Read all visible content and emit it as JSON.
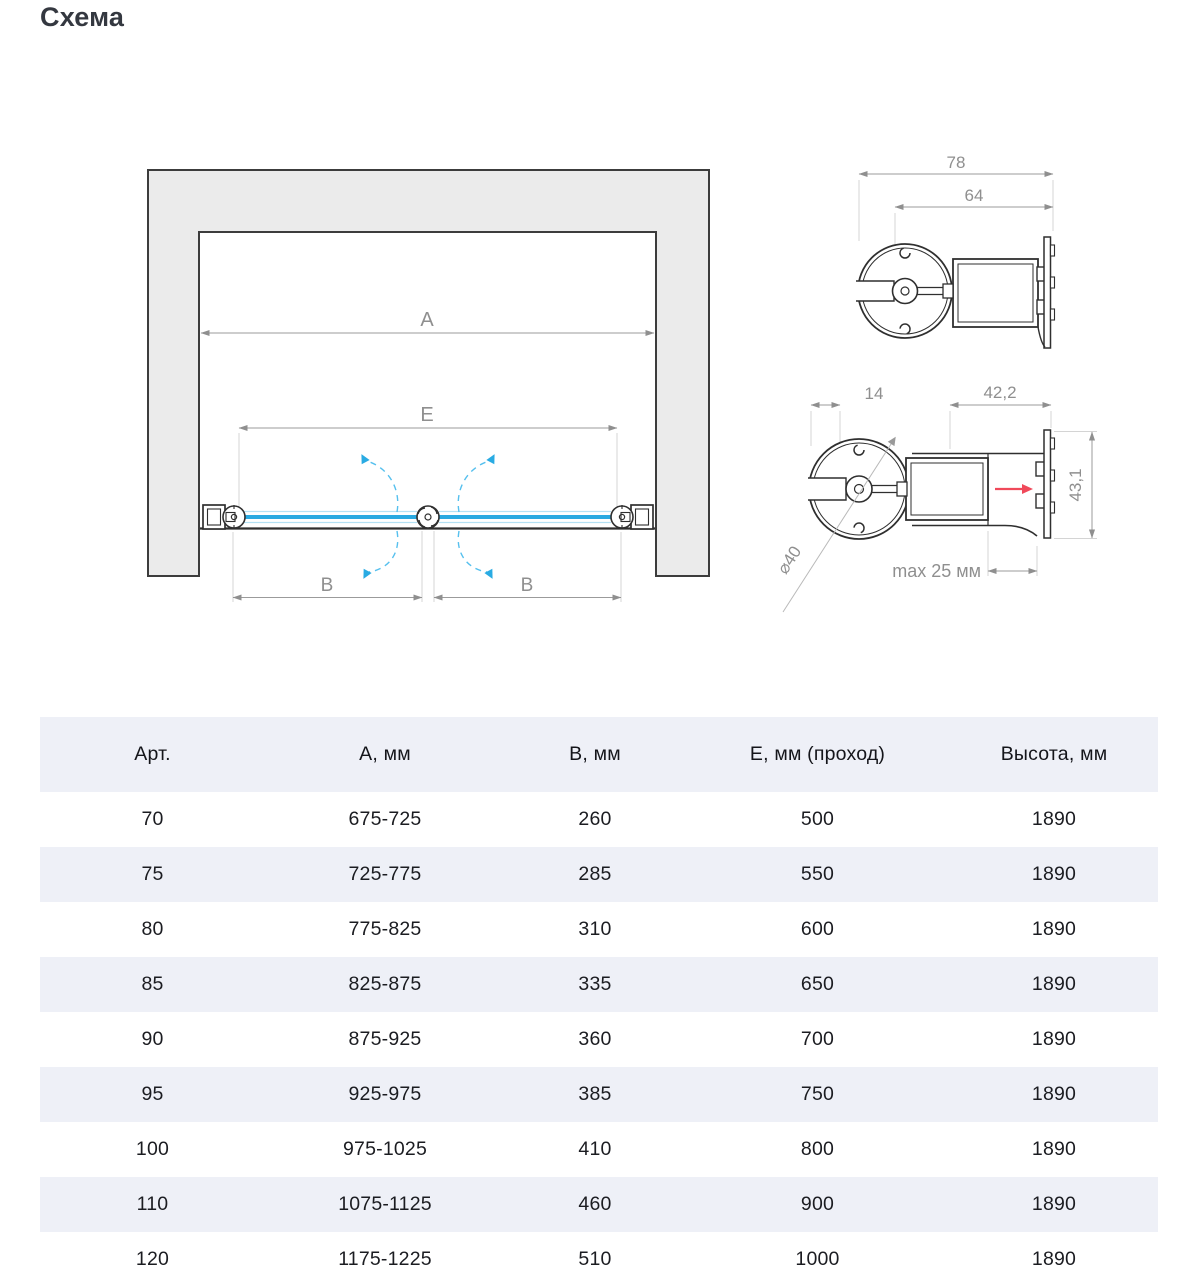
{
  "page": {
    "title": "Схема"
  },
  "diagram": {
    "dim_a": "A",
    "dim_e": "E",
    "dim_b_left": "B",
    "dim_b_right": "B"
  },
  "detail_top": {
    "dim_total_width": "78",
    "dim_inner_width": "64"
  },
  "detail_bottom": {
    "dim_offset": "14",
    "dim_profile_width": "42,2",
    "dim_profile_height": "43,1",
    "dim_diameter": "⌀40",
    "dim_adjust": "max 25 мм"
  },
  "colors": {
    "glass_blue": "#29a9e1",
    "swing_arc_blue": "#56c0ee",
    "adjust_arrow_red": "#f0495a",
    "wall_fill": "#ebebeb",
    "outline_dark": "#2f2f2f",
    "dimension_gray": "#8f8f8f",
    "table_alt_bg": "#eef0f7",
    "text_dark": "#1b1c21"
  },
  "table": {
    "headers": [
      "Арт.",
      "А, мм",
      "В, мм",
      "Е, мм (проход)",
      "Высота, мм"
    ],
    "rows": [
      [
        "70",
        "675-725",
        "260",
        "500",
        "1890"
      ],
      [
        "75",
        "725-775",
        "285",
        "550",
        "1890"
      ],
      [
        "80",
        "775-825",
        "310",
        "600",
        "1890"
      ],
      [
        "85",
        "825-875",
        "335",
        "650",
        "1890"
      ],
      [
        "90",
        "875-925",
        "360",
        "700",
        "1890"
      ],
      [
        "95",
        "925-975",
        "385",
        "750",
        "1890"
      ],
      [
        "100",
        "975-1025",
        "410",
        "800",
        "1890"
      ],
      [
        "110",
        "1075-1125",
        "460",
        "900",
        "1890"
      ],
      [
        "120",
        "1175-1225",
        "510",
        "1000",
        "1890"
      ]
    ]
  }
}
